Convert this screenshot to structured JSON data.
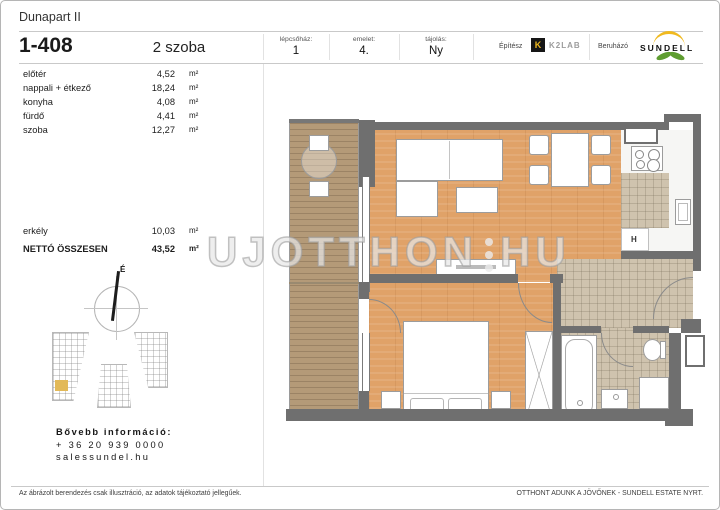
{
  "document": {
    "project": "Dunapart II",
    "unit_id": "1-408",
    "room_count": "2 szoba"
  },
  "info_bar": {
    "staircase_label": "lépcsőház:",
    "staircase_value": "1",
    "floor_label": "emelet:",
    "floor_value": "4.",
    "orientation_label": "tájolás:",
    "orientation_value": "Ny",
    "architect_label": "Építész",
    "architect_logo_letter": "K",
    "architect_name": "K2LAB",
    "developer_label": "Beruházó",
    "developer_name": "SUNDELL"
  },
  "room_table": {
    "unit": "m²",
    "rows": [
      {
        "name": "előtér",
        "area": "4,52"
      },
      {
        "name": "nappali + étkező",
        "area": "18,24"
      },
      {
        "name": "konyha",
        "area": "4,08"
      },
      {
        "name": "fürdő",
        "area": "4,41"
      },
      {
        "name": "szoba",
        "area": "12,27"
      }
    ],
    "balcony_row": {
      "name": "erkély",
      "area": "10,03"
    },
    "total_row": {
      "name": "NETTÓ ÖSSZESEN",
      "area": "43,52"
    }
  },
  "floor_plan": {
    "fridge_label": "H",
    "compass_label": "É"
  },
  "watermark": {
    "left": "UJOTTHON",
    "right": "HU"
  },
  "contact": {
    "title": "Bővebb információ:",
    "phone": "+ 36 20 939 0000",
    "website": "salessundel.hu"
  },
  "footer": {
    "disclaimer": "Az ábrázolt berendezés csak illusztráció, az adatok tájékoztató jellegűek.",
    "slogan": "OTTHONT ADUNK A JÖVŐNEK - SUNDELL ESTATE NYRT."
  },
  "colors": {
    "wall": "#6f6f6f",
    "wood_floor": "#e0a268",
    "balcony_deck": "#b49a78",
    "tile": "#cfc3ae",
    "k2lab_yellow": "#f0b91f",
    "sundell_green": "#5f9d31",
    "site_highlight": "#e2b958"
  }
}
